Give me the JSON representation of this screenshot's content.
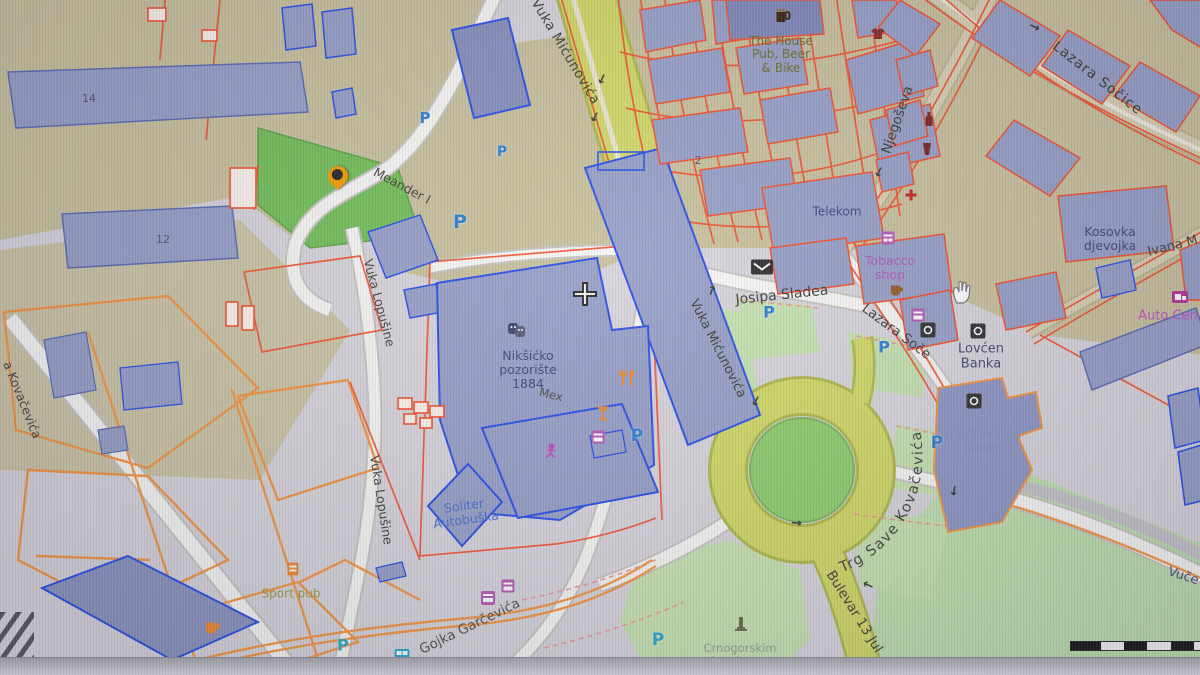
{
  "streets": {
    "vuka_micunovica": "Vuka Mićunovića",
    "vuka_micunovica_2": "Vuka Mićunovića",
    "meander": "Meander I",
    "vuka_lopusine": "Vuka Lopušine",
    "vuka_lopusine_2": "Vuka Lopušine",
    "josipa_sladea": "Josipa Sladea",
    "lazara_soce": "Lazara Soče",
    "lazara_socice": "Lazara Sočice",
    "njegoseva": "Njegoševa",
    "trg_save_kovacevica": "Trg Save Kovačevića",
    "bulevar_13_jul": "Bulevar 13 Jul",
    "gojka_garcevica": "Gojka Garčevića",
    "ivana_m": "Ivana M",
    "kovacevica_partial": "a Kovačevića",
    "vuce_partial": "Vuče"
  },
  "places": {
    "pub_house": {
      "l1": "The House",
      "l2": "Pub, Beer",
      "l3": "& Bike"
    },
    "telekom": "Telekom",
    "tobacco_shop": {
      "l1": "Tobacco",
      "l2": "shop"
    },
    "lovcen_banka": {
      "l1": "Lovćen",
      "l2": "Banka"
    },
    "hipotekarna_banka": {
      "l1": "Hipotekarna",
      "l2": "banka"
    },
    "kosovka_djevojka": {
      "l1": "Kosovka",
      "l2": "djevojka"
    },
    "auto_centar": "Auto Cen",
    "niksicko_pozoriste": {
      "l1": "Nikšićko",
      "l2": "pozorište",
      "l3": "1884"
    },
    "mex": "Mex",
    "soliter": {
      "l1": "Soliter",
      "l2": "Autobuška"
    },
    "sport_pub": "Sport pub",
    "crnogorskim_komitama": {
      "l1": "Crnogorskim",
      "l2": "komitama"
    }
  },
  "house_numbers": {
    "n14": "14",
    "n12": "12",
    "n2": "2"
  },
  "map_symbols": {
    "parking": "P",
    "oneway_arrow": "→"
  },
  "scale_bar": {
    "origin": "0"
  },
  "colors": {
    "land": "#d8d5db",
    "commercial_tan": "#c9c19d",
    "park_green": "#74bf58",
    "grass_green": "#c6e2b0",
    "roundabout_green": "#8fce6e",
    "road_yellow": "#d2d966",
    "road_white": "#f8f7f4",
    "road_tan": "#d9d1b2",
    "building_fill": "#98a0c7",
    "building_outline_blue": "#2b50e8",
    "parcel_red": "#f4512c",
    "parcel_orange": "#f6953f",
    "parking_blue": "#2a7fd4",
    "parking_teal": "#2aa7c9",
    "marker_orange": "#f59d00"
  }
}
